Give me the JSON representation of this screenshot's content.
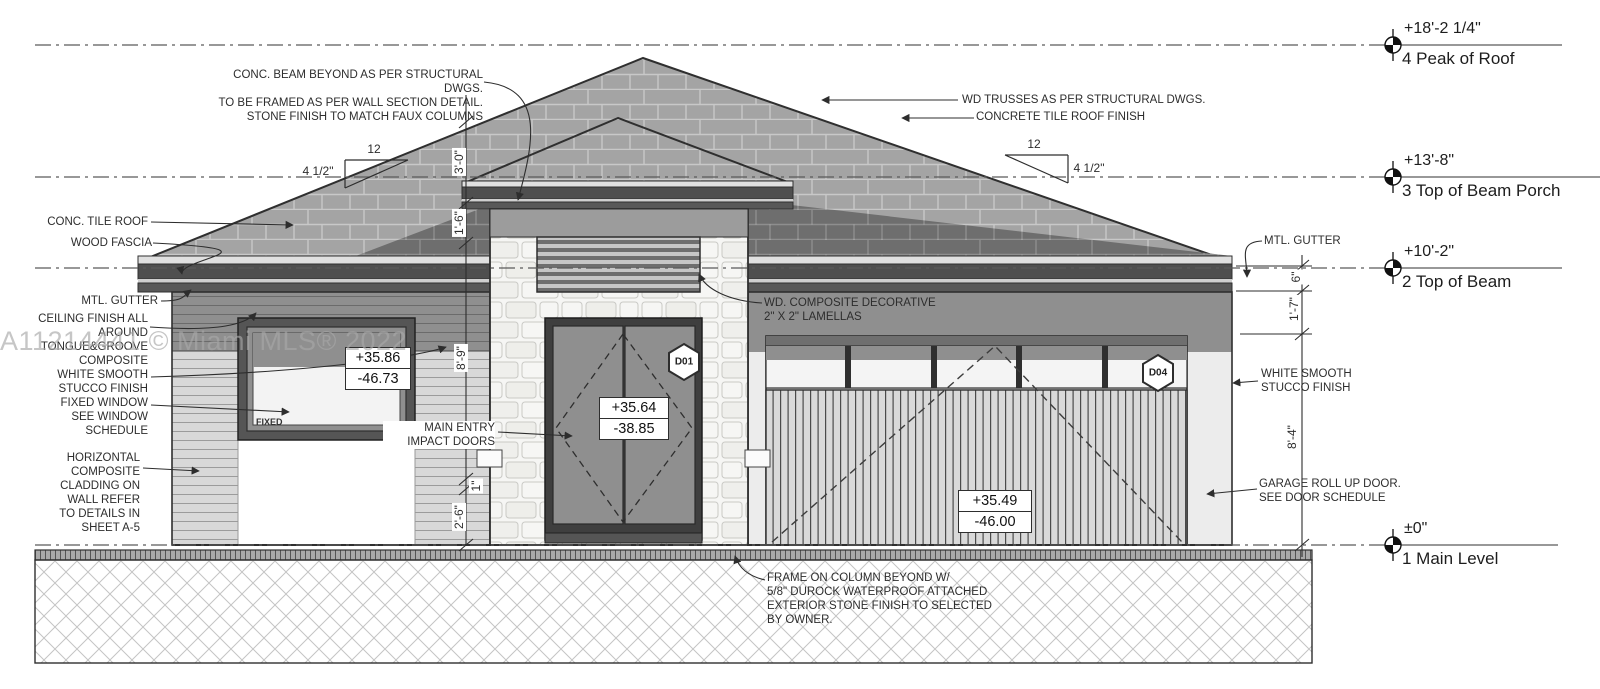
{
  "title": "House Front Elevation Drawing",
  "watermark": "A11214441 © Miami MLS® 2022",
  "levels": [
    {
      "value": "+18'-2 1/4\"",
      "name": "4 Peak of Roof"
    },
    {
      "value": "+13'-8\"",
      "name": "3 Top of Beam Porch"
    },
    {
      "value": "+10'-2\"",
      "name": "2 Top of Beam"
    },
    {
      "value": "±0\"",
      "name": "1 Main Level"
    }
  ],
  "annotations": {
    "conc_beam": "CONC. BEAM BEYOND AS PER STRUCTURAL DWGS.\nTO BE FRAMED AS PER WALL SECTION DETAIL.\nSTONE FINISH TO MATCH FAUX COLUMNS",
    "wd_trusses": "WD TRUSSES AS PER STRUCTURAL DWGS.",
    "concrete_tile_roof_finish": "CONCRETE TILE ROOF FINISH",
    "conc_tile_roof": "CONC. TILE ROOF",
    "wood_fascia": "WOOD FASCIA",
    "mtl_gutter_left": "MTL. GUTTER",
    "ceiling_finish": "CEILING FINISH ALL\nAROUND\nTONGUE&GROOVE\nCOMPOSITE",
    "white_stucco_left": "WHITE SMOOTH\nSTUCCO FINISH",
    "fixed_window": "FIXED WINDOW\nSEE WINDOW\nSCHEDULE",
    "horizontal_cladding": "HORIZONTAL\nCOMPOSITE\nCLADDING ON\nWALL REFER\nTO DETAILS IN\nSHEET A-5",
    "main_entry": "MAIN ENTRY\nIMPACT DOORS",
    "wd_lamellas": "WD. COMPOSITE DECORATIVE\n2\" X 2\" LAMELLAS",
    "frame_on_column": "FRAME ON COLUMN BEYOND W/\n5/8\" DUROCK WATERPROOF ATTACHED\nEXTERIOR STONE FINISH TO SELECTED\nBY OWNER.",
    "mtl_gutter_right": "MTL. GUTTER",
    "white_stucco_right": "WHITE SMOOTH\nSTUCCO FINISH",
    "garage_door": "GARAGE ROLL UP DOOR.\nSEE DOOR SCHEDULE",
    "fixed_label": "FIXED"
  },
  "dimensions": {
    "d3_0": "3'-0\"",
    "d1_6": "1'-6\"",
    "d8_9": "8'-9\"",
    "d1": "1\"",
    "d2_6": "2'-6\"",
    "d6": "6\"",
    "d1_7": "1'-7\"",
    "d8_4": "8'-4\"",
    "slope_run": "12",
    "slope_rise": "4 1/2\""
  },
  "tags": {
    "entry_door": "D01",
    "garage_door": "D04"
  },
  "value_boxes": {
    "window": {
      "top": "+35.86",
      "bottom": "-46.73"
    },
    "entry": {
      "top": "+35.64",
      "bottom": "-38.85"
    },
    "garage": {
      "top": "+35.49",
      "bottom": "-46.00"
    }
  },
  "colors": {
    "line": "#333333",
    "roof_tile": "#a4a4a4",
    "roof_dark": "#6e6e6e",
    "fascia": "#4f4f4f",
    "wall_shadow": "#8f8f8f",
    "cladding": "#d8d8d8",
    "stone": "#f6f6f4",
    "door": "#8f8f8f",
    "garage_slats": "#d9d9d9",
    "watermark": "#a8a8a8",
    "background": "#ffffff"
  }
}
